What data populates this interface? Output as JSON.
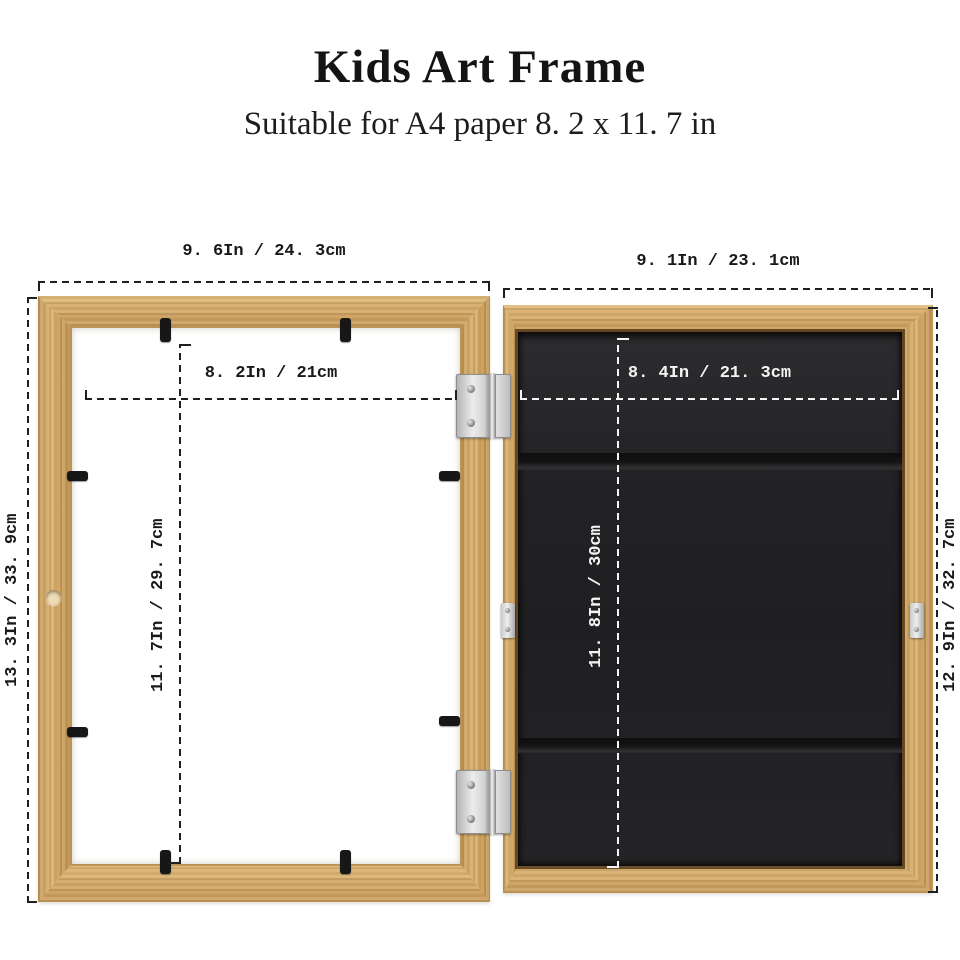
{
  "header": {
    "title": "Kids Art Frame",
    "subtitle": "Suitable for A4 paper 8. 2 x 11. 7 in"
  },
  "dimensions": {
    "front_frame": {
      "outer_width": "9. 6In / 24. 3cm",
      "outer_height": "13. 3In / 33. 9cm",
      "opening_width": "8. 2In / 21cm",
      "opening_height": "11. 7In / 29. 7cm"
    },
    "back_frame": {
      "outer_width": "9. 1In / 23. 1cm",
      "outer_height": "12. 9In / 32. 7cm",
      "board_width": "8. 4In / 21. 3cm",
      "board_height": "11. 8In / 30cm"
    }
  },
  "colors": {
    "wood": "#d2a763",
    "panel_black": "#212123",
    "annotation_dark": "#1f1f1f",
    "annotation_light": "#f5f5f5"
  }
}
